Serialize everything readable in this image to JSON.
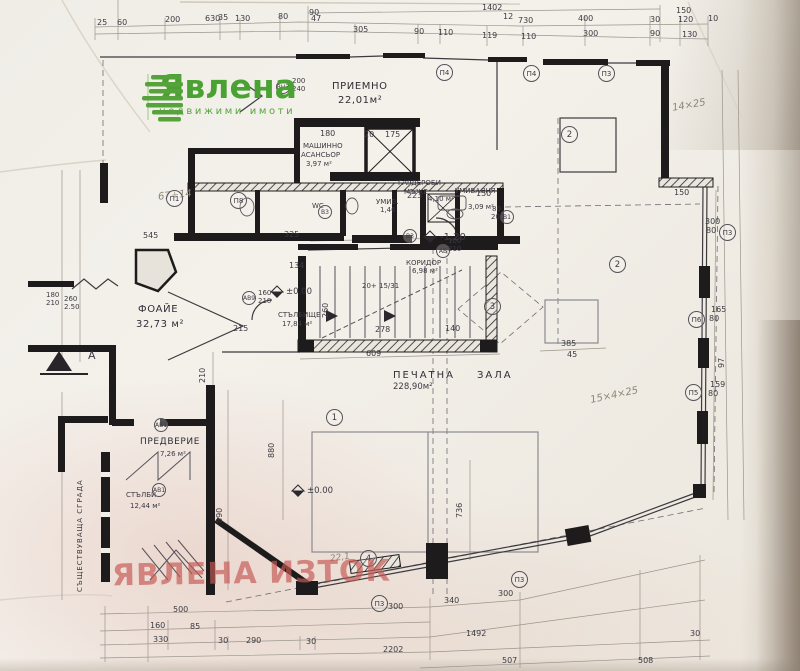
{
  "logo": {
    "brand": "Явлена",
    "tagline": "недвижими имоти"
  },
  "watermark": "ЯВЛЕНА ИЗТОК",
  "rooms": {
    "reception": {
      "name": "ПРИЕМНО",
      "area": "22,01м²"
    },
    "machine": {
      "name": "МАШИННО",
      "name2": "АСАНСЬОР",
      "area": "3,97 м²"
    },
    "wardrobe": {
      "name": "ГАРДЕРОБИ",
      "name2": "МЪЖЕ",
      "area": "4,10 м²"
    },
    "washroom": {
      "name": "УМИВАЛНЯ",
      "area": "3,09 м²"
    },
    "wc": {
      "name": "WC"
    },
    "umiv": {
      "name": "УМИВ.",
      "area": "1,46"
    },
    "corridor": {
      "name": "КОРИДОР",
      "area": "6,98 м²"
    },
    "foyer": {
      "name": "ФОАЙЕ",
      "area": "32,73 м²"
    },
    "stairwell": {
      "name": "СТЪЛБИЩЕ",
      "area": "17,84 м²"
    },
    "print_hall": {
      "name": "ПЕЧАТНА",
      "name2": "ЗАЛА",
      "area": "228,90м²"
    },
    "vestibule": {
      "name": "ПРЕДВЕРИЕ",
      "area": "7,26 м²"
    },
    "stairs": {
      "name": "СТЪЛБИ",
      "area": "12,44 м²"
    },
    "existing": {
      "name": "СЪЩЕСТВУВАЩА СГРАДА"
    }
  },
  "levels": {
    "zero": "±0.00",
    "minus": "-1,20"
  },
  "stair_note": "20+ 15/31",
  "markers": {
    "section": "А",
    "vn3": "ВН3",
    "p4": "П4",
    "p3": "П3",
    "p1": "П1",
    "p8": "П8",
    "v3": "В3",
    "v1": "В1",
    "av": "АВ",
    "av9": "АВ9",
    "av1": "АВ1",
    "p5": "П5",
    "p6": "П6",
    "r1": "1",
    "r2": "2",
    "r3": "3",
    "r4": "4"
  },
  "pencil": {
    "n1": "67+14",
    "n2": "14×25",
    "n3": "15×4×25",
    "n4": "22,1"
  },
  "dims": {
    "top": [
      "1402",
      "630",
      "730",
      "150",
      "90",
      "25",
      "60",
      "200",
      "35",
      "130",
      "80",
      "47",
      "12",
      "400",
      "30",
      "120",
      "10",
      "305",
      "90",
      "110",
      "119",
      "110",
      "300",
      "90",
      "130"
    ],
    "bottom": [
      "500",
      "160",
      "85",
      "330",
      "30",
      "290",
      "30",
      "340",
      "300",
      "300",
      "1492",
      "30",
      "2202",
      "507",
      "508"
    ],
    "inner": [
      "545",
      "325",
      "134",
      "215",
      "278",
      "140",
      "609",
      "385",
      "180",
      "20",
      "175",
      "150",
      "223",
      "100",
      "210",
      "80",
      "200",
      "160",
      "210",
      "200",
      "240",
      "260",
      "210",
      "890",
      "880",
      "150",
      "300",
      "80",
      "165",
      "80",
      "159",
      "80",
      "97",
      "45",
      "260",
      "2.50",
      "736"
    ],
    "left": [
      "180",
      "210"
    ]
  }
}
